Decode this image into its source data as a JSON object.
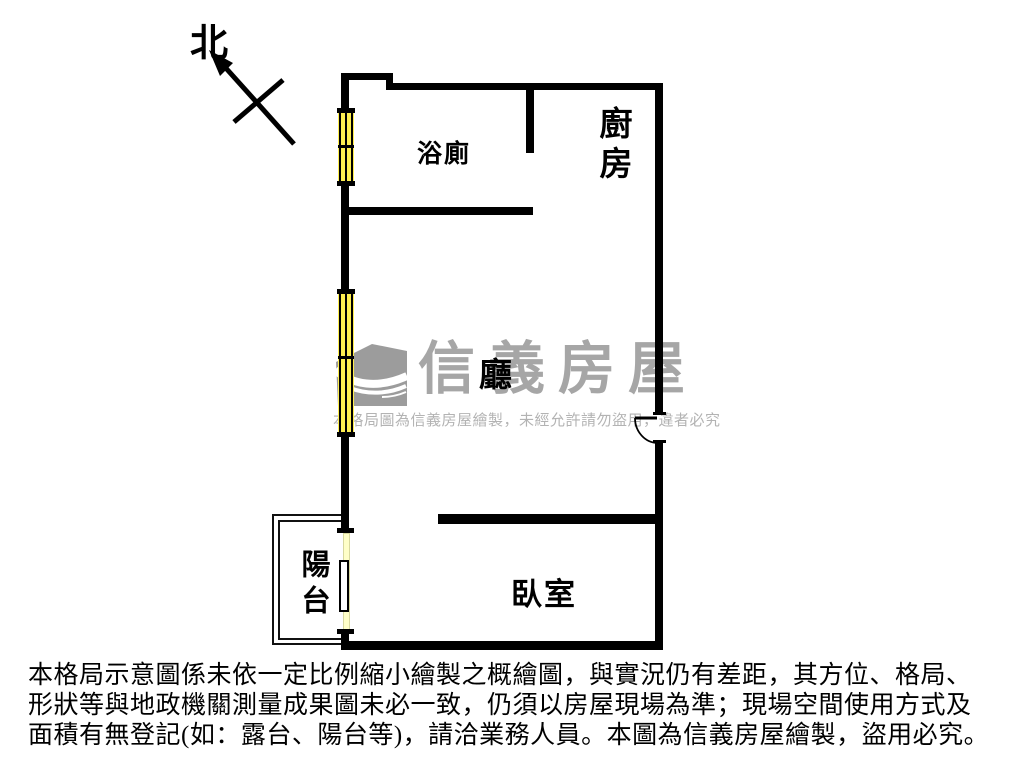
{
  "compass": {
    "label": "北"
  },
  "rooms": {
    "bathroom": {
      "label": "浴廁"
    },
    "kitchen": {
      "label": "廚房"
    },
    "living": {
      "label": "廳"
    },
    "balcony": {
      "label": "陽台"
    },
    "bedroom": {
      "label": "臥室"
    }
  },
  "watermark": {
    "brand": "信義房屋",
    "notice": "本格局圖為信義房屋繪製，未經允許請勿盜用，違者必究"
  },
  "disclaimer": {
    "lines": [
      "本格局示意圖係未依一定比例縮小繪製之概繪圖，與實況仍有差距，其方位、格局、",
      "形狀等與地政機關測量成果圖未必一致，仍須以房屋現場為準；現場空間使用方式及",
      "面積有無登記(如：露台、陽台等)，請洽業務人員。本圖為信義房屋繪製，盜用必究。"
    ]
  },
  "colors": {
    "wall": "#000000",
    "window_glass": "#ffef50",
    "sliding_glass": "#ffffc8",
    "watermark_gray": "#a6a6a6"
  }
}
